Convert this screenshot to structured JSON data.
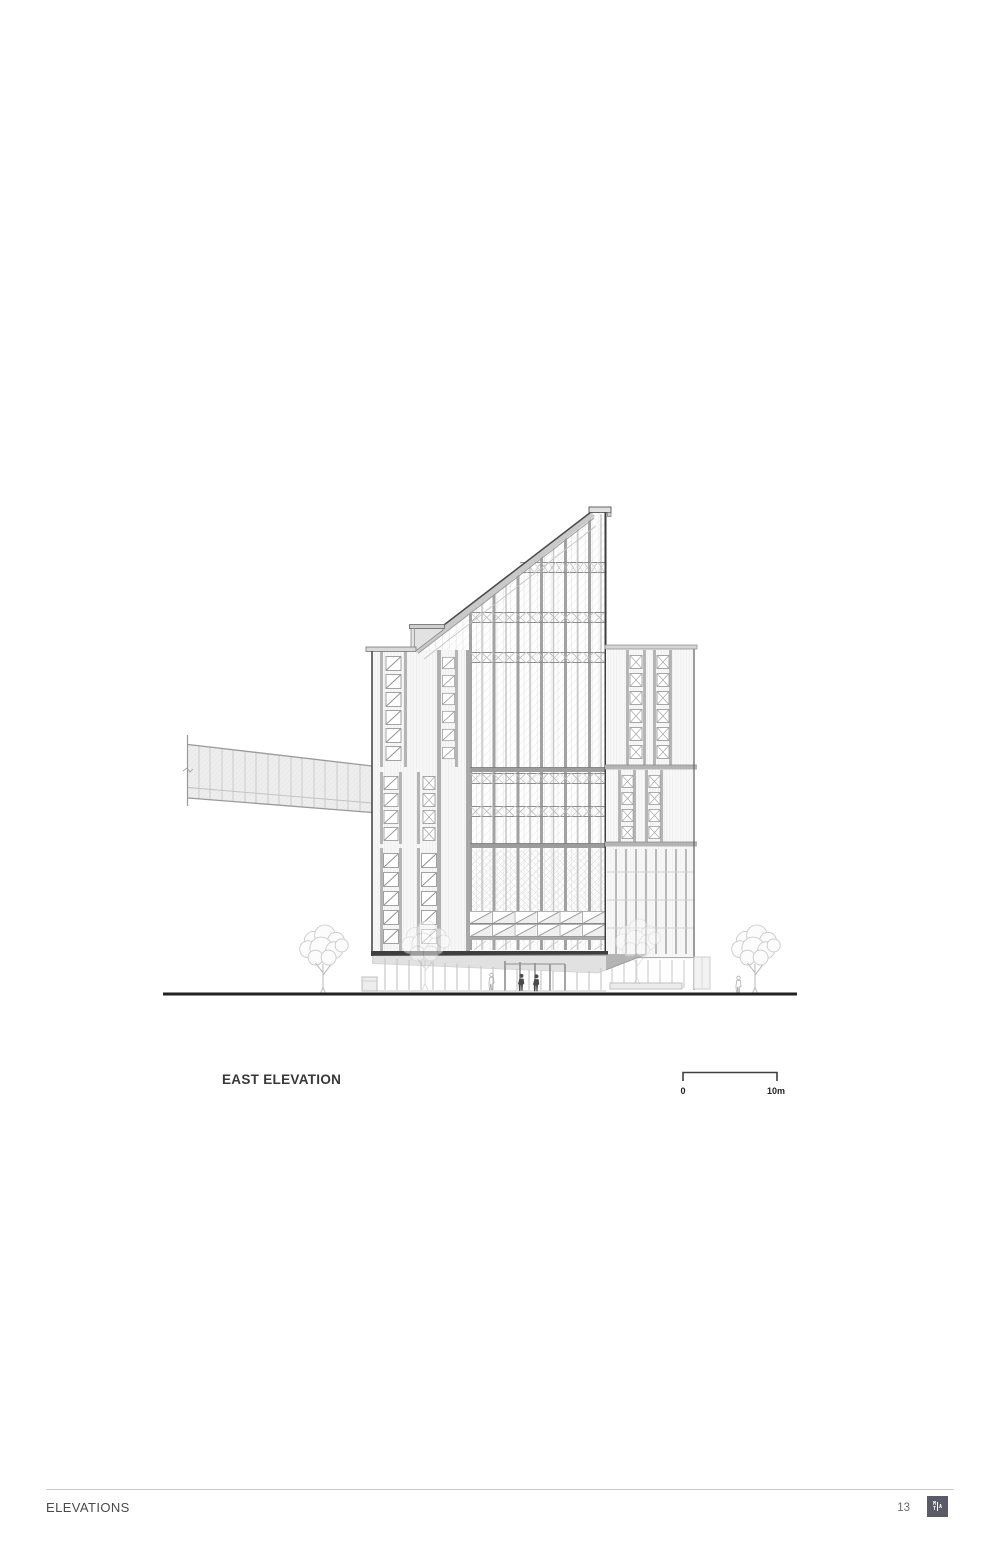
{
  "drawing": {
    "title": "EAST ELEVATION",
    "type": "architectural elevation line drawing",
    "features": [
      "slanted shed roof tower",
      "right annex block",
      "skybridge to the left",
      "street trees",
      "ground line",
      "entry canopy"
    ]
  },
  "scale_bar": {
    "start_label": "0",
    "end_label": "10m"
  },
  "footer": {
    "section_label": "ELEVATIONS",
    "page_number": "13",
    "logo": {
      "top_left": "M",
      "bottom_left": "T",
      "right": "A"
    }
  },
  "colors": {
    "page_background": "#ffffff",
    "line_dark": "#3e3e3e",
    "line_medium": "#9c9c9c",
    "line_light": "#d9d9d9",
    "logo_background": "#5b5b67"
  }
}
